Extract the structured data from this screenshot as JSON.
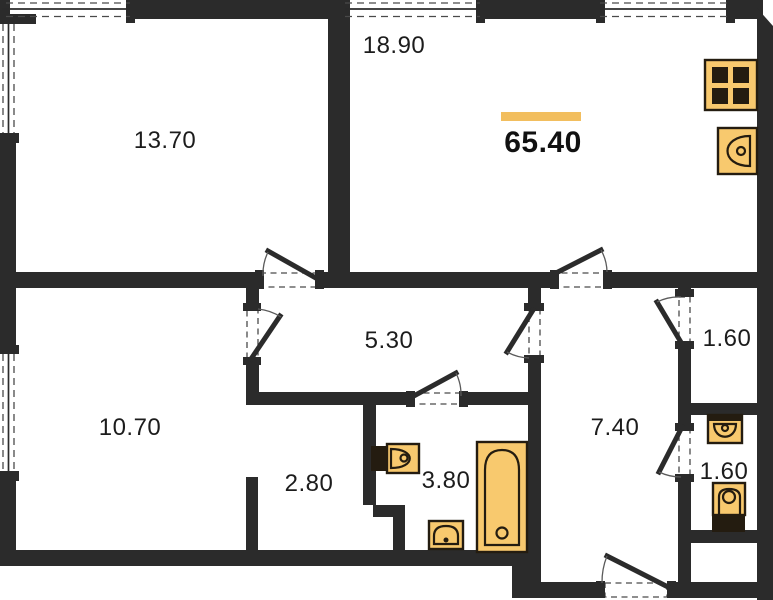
{
  "plan": {
    "type": "apartment-floor-plan",
    "total_area": {
      "value": "65.40"
    },
    "rooms": [
      {
        "name": "living-kitchen",
        "area": "18.90"
      },
      {
        "name": "bedroom-top-left",
        "area": "13.70"
      },
      {
        "name": "bedroom-bottom-left",
        "area": "10.70"
      },
      {
        "name": "corridor",
        "area": "5.30"
      },
      {
        "name": "wardrobe-niche",
        "area": "2.80"
      },
      {
        "name": "bathroom",
        "area": "3.80"
      },
      {
        "name": "entrance-hall",
        "area": "7.40"
      },
      {
        "name": "storage",
        "area": "1.60"
      },
      {
        "name": "wc",
        "area": "1.60"
      }
    ],
    "fixtures": [
      {
        "name": "stove"
      },
      {
        "name": "kitchen-sink"
      },
      {
        "name": "washbasin"
      },
      {
        "name": "bathtub"
      },
      {
        "name": "pedestal-basin"
      },
      {
        "name": "wc-washbasin"
      },
      {
        "name": "toilet"
      }
    ],
    "colors": {
      "wall": "#2b2b2b",
      "fixture_fill": "#f8c96e",
      "fixture_outline": "#241c10",
      "highlight": "#f2be5e",
      "background": "#ffffff",
      "text": "#1c1c1c"
    }
  }
}
